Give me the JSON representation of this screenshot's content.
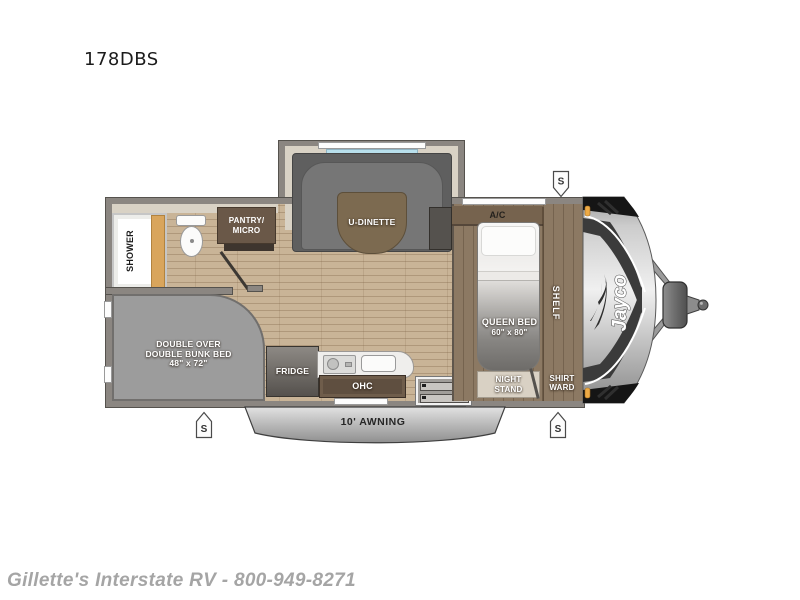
{
  "model": "178DBS",
  "dealer_watermark": "Gillette's Interstate RV - 800-949-8271",
  "brand_logo": "Jayco",
  "speaker_symbol": "S",
  "rooms": {
    "shower": "SHOWER",
    "pantry_line1": "PANTRY/",
    "pantry_line2": "MICRO",
    "dinette": "U-DINETTE",
    "ac": "A/C",
    "queen_line1": "QUEEN BED",
    "queen_line2": "60\" x 80\"",
    "shelf": "SHELF",
    "bunk_line1": "DOUBLE OVER",
    "bunk_line2": "DOUBLE BUNK BED",
    "bunk_line3": "48\" x 72\"",
    "fridge": "FRIDGE",
    "ohc": "OHC",
    "nightstand_line1": "NIGHT",
    "nightstand_line2": "STAND",
    "wardrobe_line1": "SHIRT",
    "wardrobe_line2": "WARD",
    "awning": "10' AWNING"
  },
  "colors": {
    "floor_wood": "#c9b497",
    "platform_wood": "#8c7963",
    "wall_gray": "#8b8681",
    "cabinet_brown": "#6a5848",
    "couch_gray": "#6a6a6a",
    "bunk_gray": "#9c9c9c",
    "slide_interior": "#d9d2c5",
    "marker_amber": "#edaa45",
    "cap_silver": "#d6d6d6"
  }
}
